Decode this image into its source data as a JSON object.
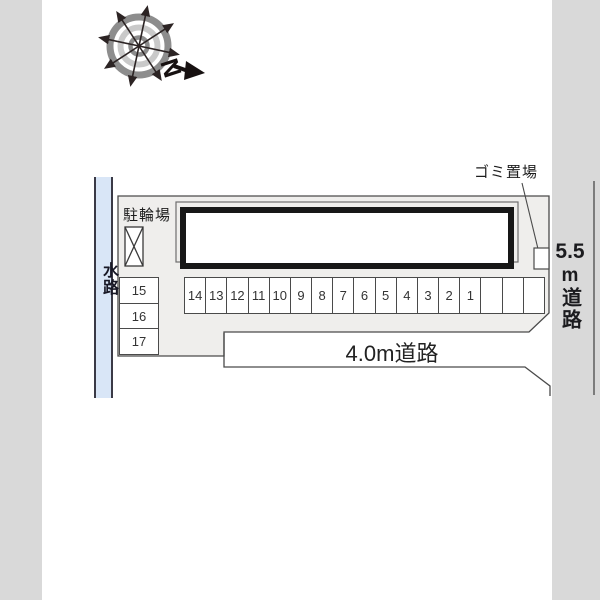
{
  "plan": {
    "compass_label": "N",
    "waterway_label": "水路",
    "bicycle_parking_label": "駐輪場",
    "garbage_area_label": "ゴミ置場",
    "right_road": {
      "width_value": "5.5",
      "unit": "m",
      "road_word": "道路"
    },
    "bottom_road_label": "4.0m道路",
    "parking_spaces_row": [
      "14",
      "13",
      "12",
      "11",
      "10",
      "9",
      "8",
      "7",
      "6",
      "5",
      "4",
      "3",
      "2",
      "1",
      "",
      "",
      ""
    ],
    "parking_spaces_column": [
      "15",
      "16",
      "17"
    ]
  },
  "colors": {
    "page_background": "#d9d9d9",
    "paper": "#ffffff",
    "site_fill": "#efeeec",
    "waterway_fill": "#d9e6f7",
    "line": "#4a4a4a",
    "building_border": "#171717",
    "compass_ring": "#8d8d8d"
  }
}
